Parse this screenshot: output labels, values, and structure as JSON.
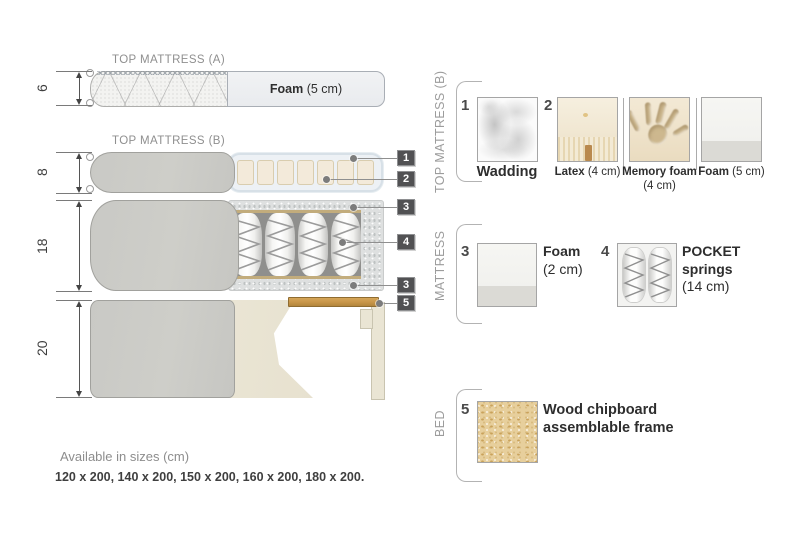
{
  "diagram": {
    "top_mattress_a": {
      "title": "TOP MATTRESS (A)",
      "dim": "6",
      "foam_bold": "Foam",
      "foam_normal": "(5 cm)"
    },
    "top_mattress_b": {
      "title": "TOP MATTRESS (B)",
      "dim": "8"
    },
    "mattress": {
      "dim": "18"
    },
    "bed": {
      "dim": "20"
    },
    "callouts": [
      "1",
      "2",
      "3",
      "4",
      "3",
      "5"
    ]
  },
  "panels": [
    {
      "title": "TOP MATTRESS (B)",
      "items": [
        {
          "num": "1",
          "bold": "Wadding",
          "normal": ""
        },
        {
          "num": "2",
          "bold": "Latex",
          "normal": "(4 cm)"
        },
        {
          "num": "",
          "bold": "Memory foam",
          "normal": "(4 cm)"
        },
        {
          "num": "",
          "bold": "Foam",
          "normal": "(5 cm)"
        }
      ]
    },
    {
      "title": "MATTRESS",
      "items": [
        {
          "num": "3",
          "bold": "Foam",
          "normal": "(2 cm)"
        },
        {
          "num": "4",
          "bold": "POCKET springs",
          "normal": "(14 cm)"
        }
      ]
    },
    {
      "title": "BED",
      "items": [
        {
          "num": "5",
          "bold": "Wood chipboard assemblable frame",
          "normal": ""
        }
      ]
    }
  ],
  "footer": {
    "line1": "Available in sizes (cm)",
    "line2": "120 x 200, 140 x 200, 150 x 200, 160 x 200, 180 x 200."
  },
  "colors": {
    "wood_slat": "#c79548",
    "callout_bg": "#515153",
    "foam_block": "#f3eada",
    "cover_grey": "#cbcbc7",
    "chipboard": "#e7cf9c"
  }
}
